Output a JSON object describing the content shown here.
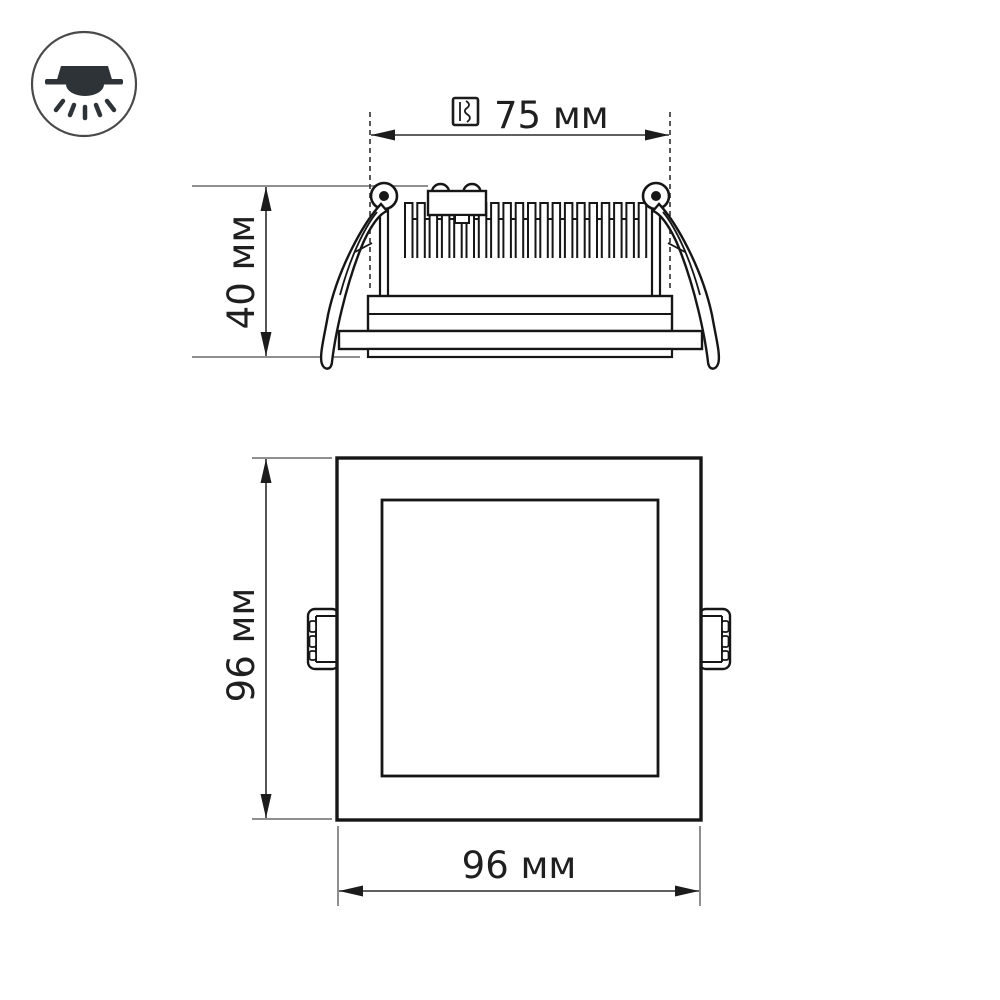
{
  "drawing": {
    "background": "#ffffff",
    "stroke_color": "#161616",
    "dimension_line_color": "#2b2b2b",
    "extension_line_color": "#8f8f8f",
    "labels": {
      "cutout_diameter": "75 мм",
      "recess_depth": "40 мм",
      "panel_height": "96 мм",
      "panel_width": "96 мм"
    },
    "icons": {
      "badge": "recessed-downlight-icon",
      "cutout": "cutout-hole-icon"
    }
  }
}
